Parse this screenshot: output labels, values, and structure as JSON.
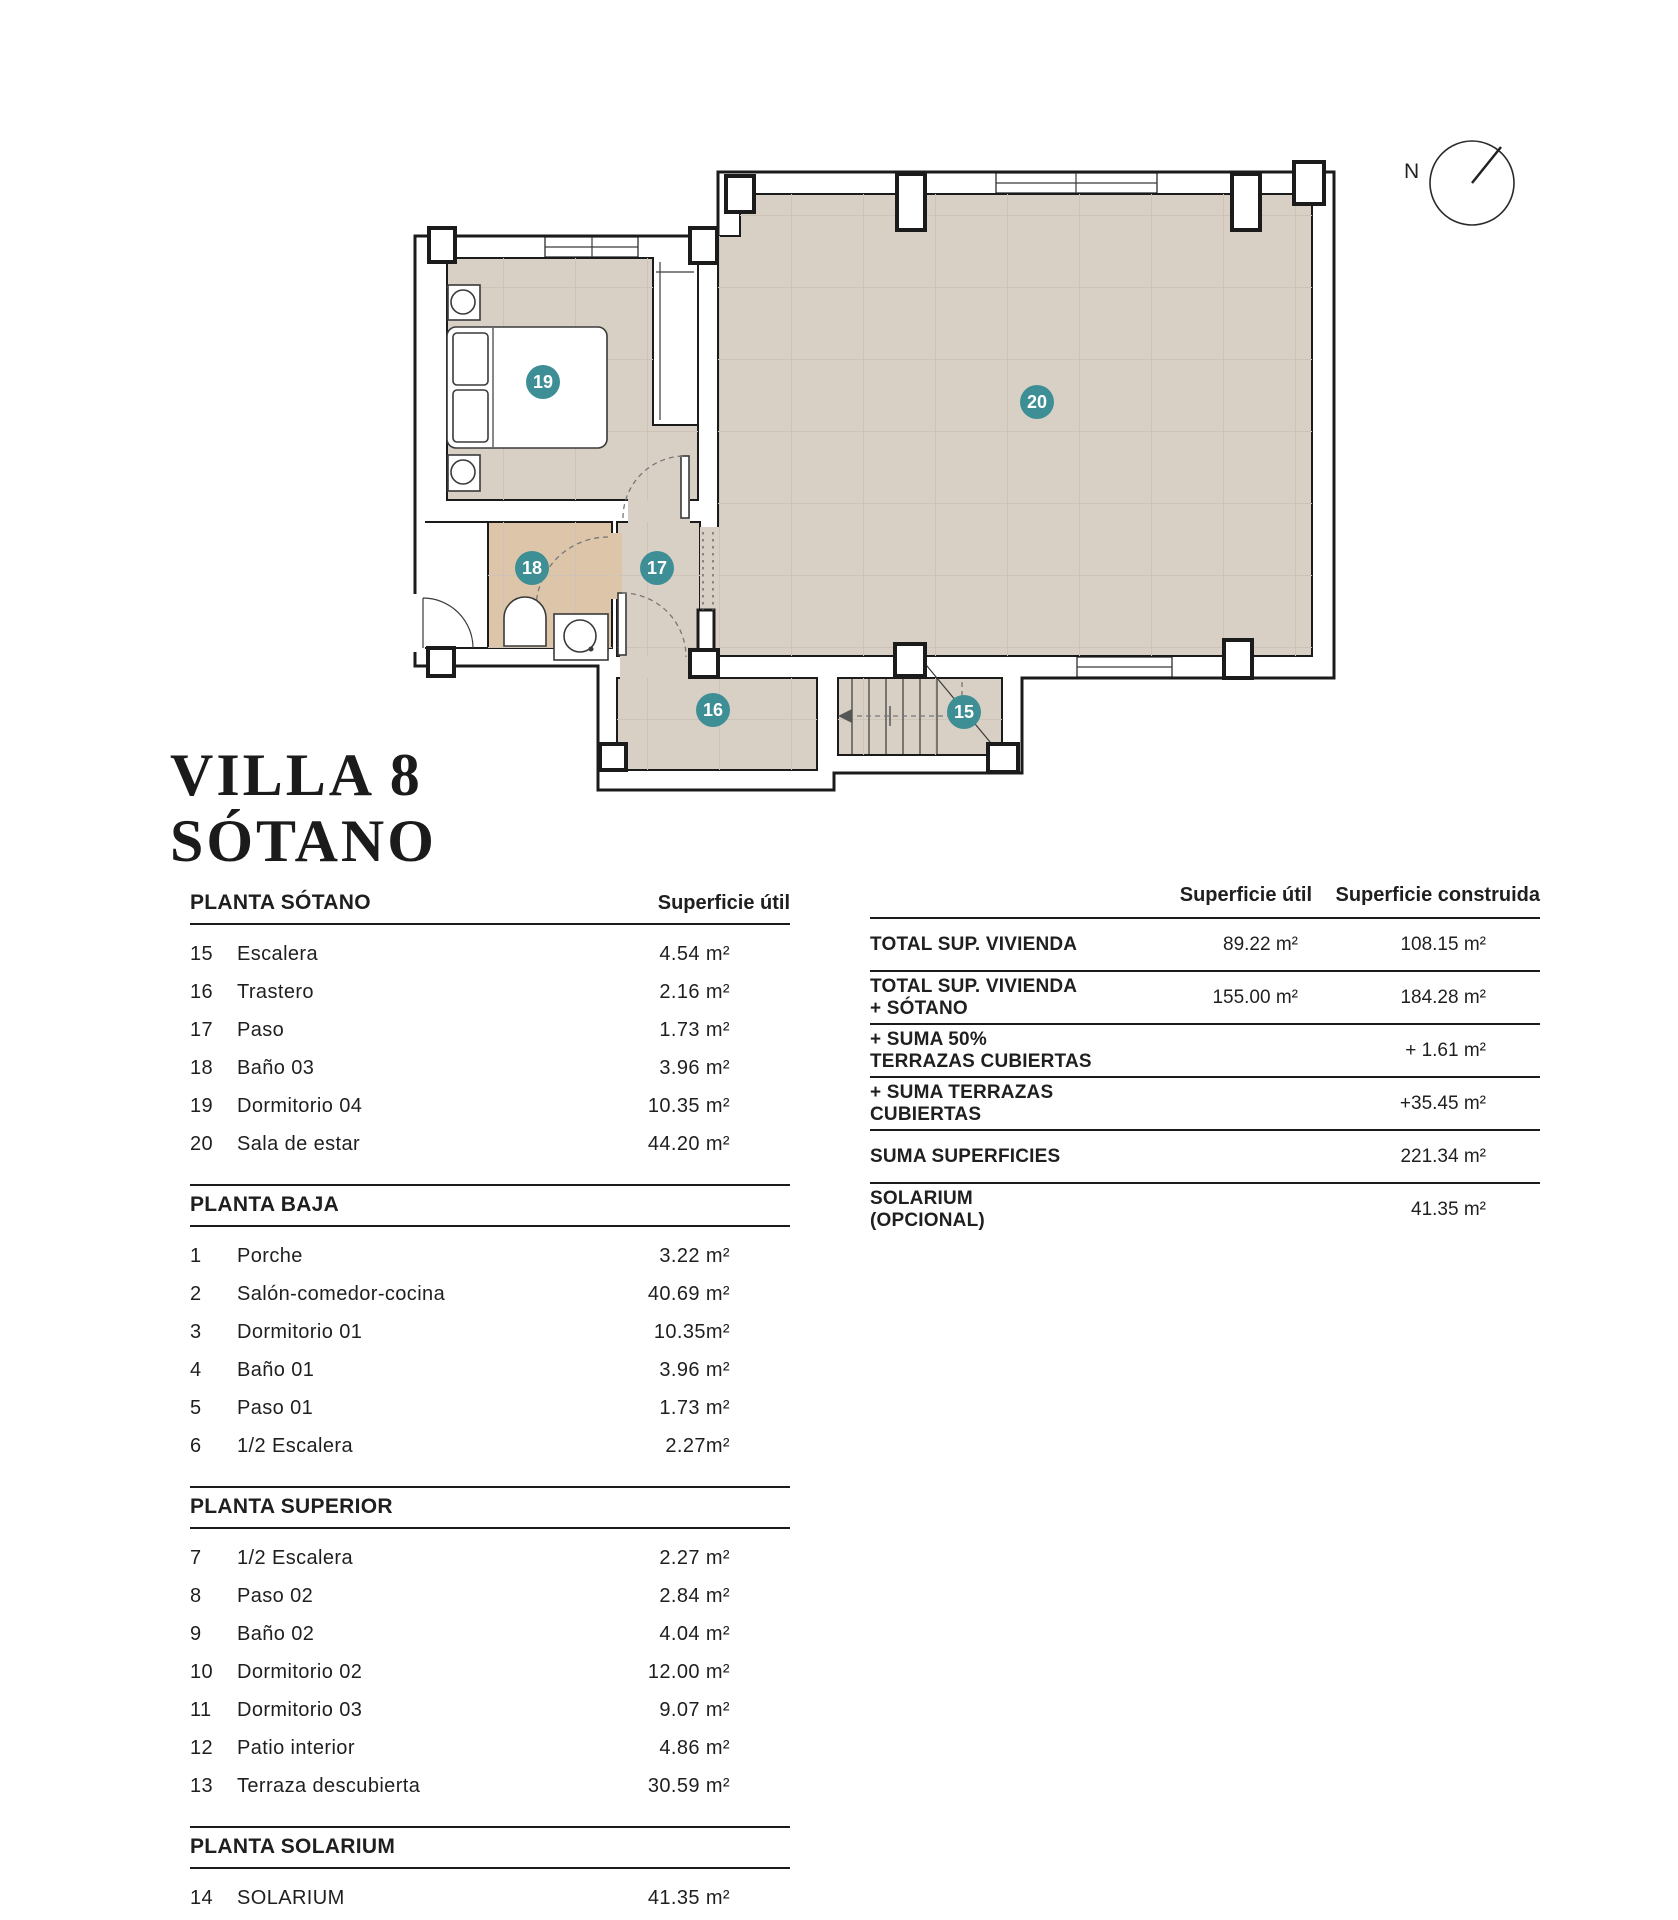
{
  "title": {
    "line1": "VILLA 8",
    "line2": "SÓTANO"
  },
  "plan": {
    "compass_label": "N",
    "markers": [
      {
        "label": "15"
      },
      {
        "label": "16"
      },
      {
        "label": "17"
      },
      {
        "label": "18"
      },
      {
        "label": "19"
      },
      {
        "label": "20"
      }
    ],
    "colors": {
      "floor": "#d9d0c5",
      "floor_grid": "#cdc4b7",
      "bath_floor": "#dcc5a8",
      "marker": "#3e8e96",
      "wall": "#1b1b1b"
    }
  },
  "left_table": {
    "area_header": "Superficie útil",
    "sections": [
      {
        "title": "PLANTA SÓTANO",
        "rows": [
          [
            "15",
            "Escalera",
            "4.54 m²"
          ],
          [
            "16",
            "Trastero",
            "2.16 m²"
          ],
          [
            "17",
            "Paso",
            "1.73 m²"
          ],
          [
            "18",
            "Baño 03",
            "3.96 m²"
          ],
          [
            "19",
            "Dormitorio 04",
            "10.35 m²"
          ],
          [
            "20",
            "Sala de estar",
            "44.20 m²"
          ]
        ]
      },
      {
        "title": "PLANTA BAJA",
        "rows": [
          [
            "1",
            "Porche",
            "3.22 m²"
          ],
          [
            "2",
            "Salón-comedor-cocina",
            "40.69 m²"
          ],
          [
            "3",
            "Dormitorio 01",
            "10.35m²"
          ],
          [
            "4",
            "Baño 01",
            "3.96 m²"
          ],
          [
            "5",
            "Paso 01",
            "1.73 m²"
          ],
          [
            "6",
            "1/2 Escalera",
            "2.27m²"
          ]
        ]
      },
      {
        "title": "PLANTA SUPERIOR",
        "rows": [
          [
            "7",
            "1/2 Escalera",
            "2.27 m²"
          ],
          [
            "8",
            "Paso 02",
            "2.84 m²"
          ],
          [
            "9",
            "Baño 02",
            "4.04 m²"
          ],
          [
            "10",
            "Dormitorio 02",
            "12.00 m²"
          ],
          [
            "11",
            "Dormitorio 03",
            "9.07 m²"
          ],
          [
            "12",
            "Patio interior",
            "4.86 m²"
          ],
          [
            "13",
            "Terraza descubierta",
            "30.59 m²"
          ]
        ]
      },
      {
        "title": "PLANTA SOLARIUM",
        "rows": [
          [
            "14",
            "SOLARIUM",
            "41.35 m²"
          ]
        ]
      }
    ]
  },
  "right_table": {
    "col_util": "Superficie útil",
    "col_built": "Superficie construida",
    "rows": [
      {
        "label": "TOTAL SUP. VIVIENDA",
        "util": "89.22 m²",
        "built": "108.15 m²"
      },
      {
        "label": "TOTAL SUP. VIVIENDA + SÓTANO",
        "util": "155.00 m²",
        "built": "184.28 m²"
      },
      {
        "label": "+ SUMA 50% TERRAZAS CUBIERTAS",
        "util": "",
        "built": "+ 1.61 m²"
      },
      {
        "label": "+ SUMA TERRAZAS CUBIERTAS",
        "util": "",
        "built": "+35.45 m²"
      },
      {
        "label": "SUMA SUPERFICIES",
        "util": "",
        "built": "221.34 m²"
      },
      {
        "label": "SOLARIUM (OPCIONAL)",
        "util": "",
        "built": "41.35 m²"
      }
    ]
  }
}
